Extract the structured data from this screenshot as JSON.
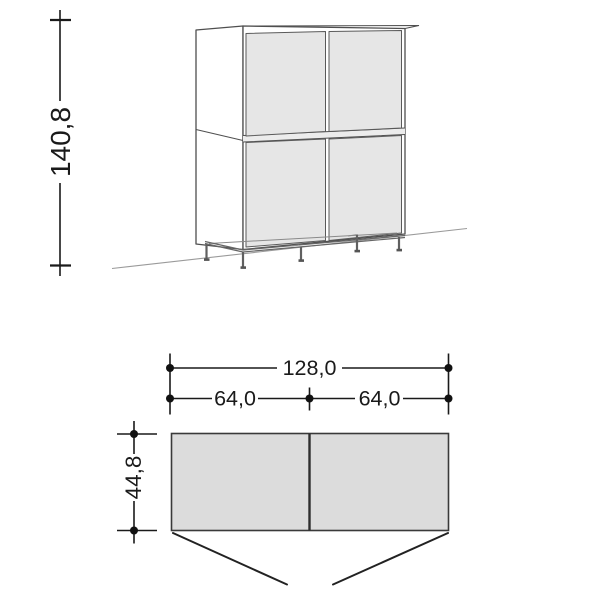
{
  "title": "Cabinet dimension drawing",
  "front_view": {
    "height_label": "140,8"
  },
  "plan_view": {
    "total_width_label": "128,0",
    "left_width_label": "64,0",
    "right_width_label": "64,0",
    "depth_label": "44,8"
  },
  "colors": {
    "background": "#ffffff",
    "door_fill": "#e6e6e6",
    "plan_fill": "#dcdcdc",
    "cabinet_outline": "#4f4f4f",
    "dimension_line": "#1a1a1a",
    "floor_line": "#9a9a9a"
  }
}
